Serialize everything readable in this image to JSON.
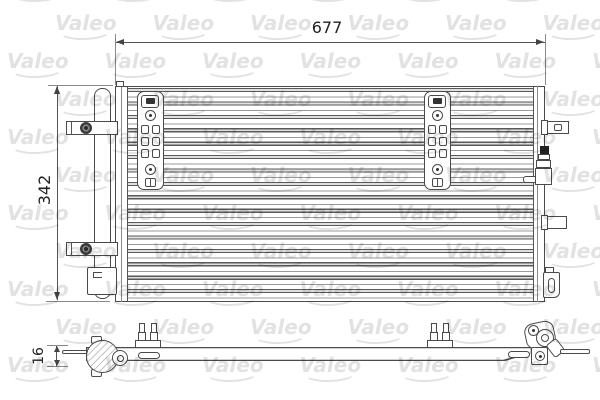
{
  "drawing": {
    "dimensions": {
      "width_mm": "677",
      "height_mm": "342",
      "thickness_mm": "16"
    },
    "watermark": {
      "text": "Valeo"
    },
    "colors": {
      "line": "#4a4a4a",
      "dimension_text": "#222222",
      "watermark": "#e2e2e2",
      "background": "#ffffff"
    }
  }
}
